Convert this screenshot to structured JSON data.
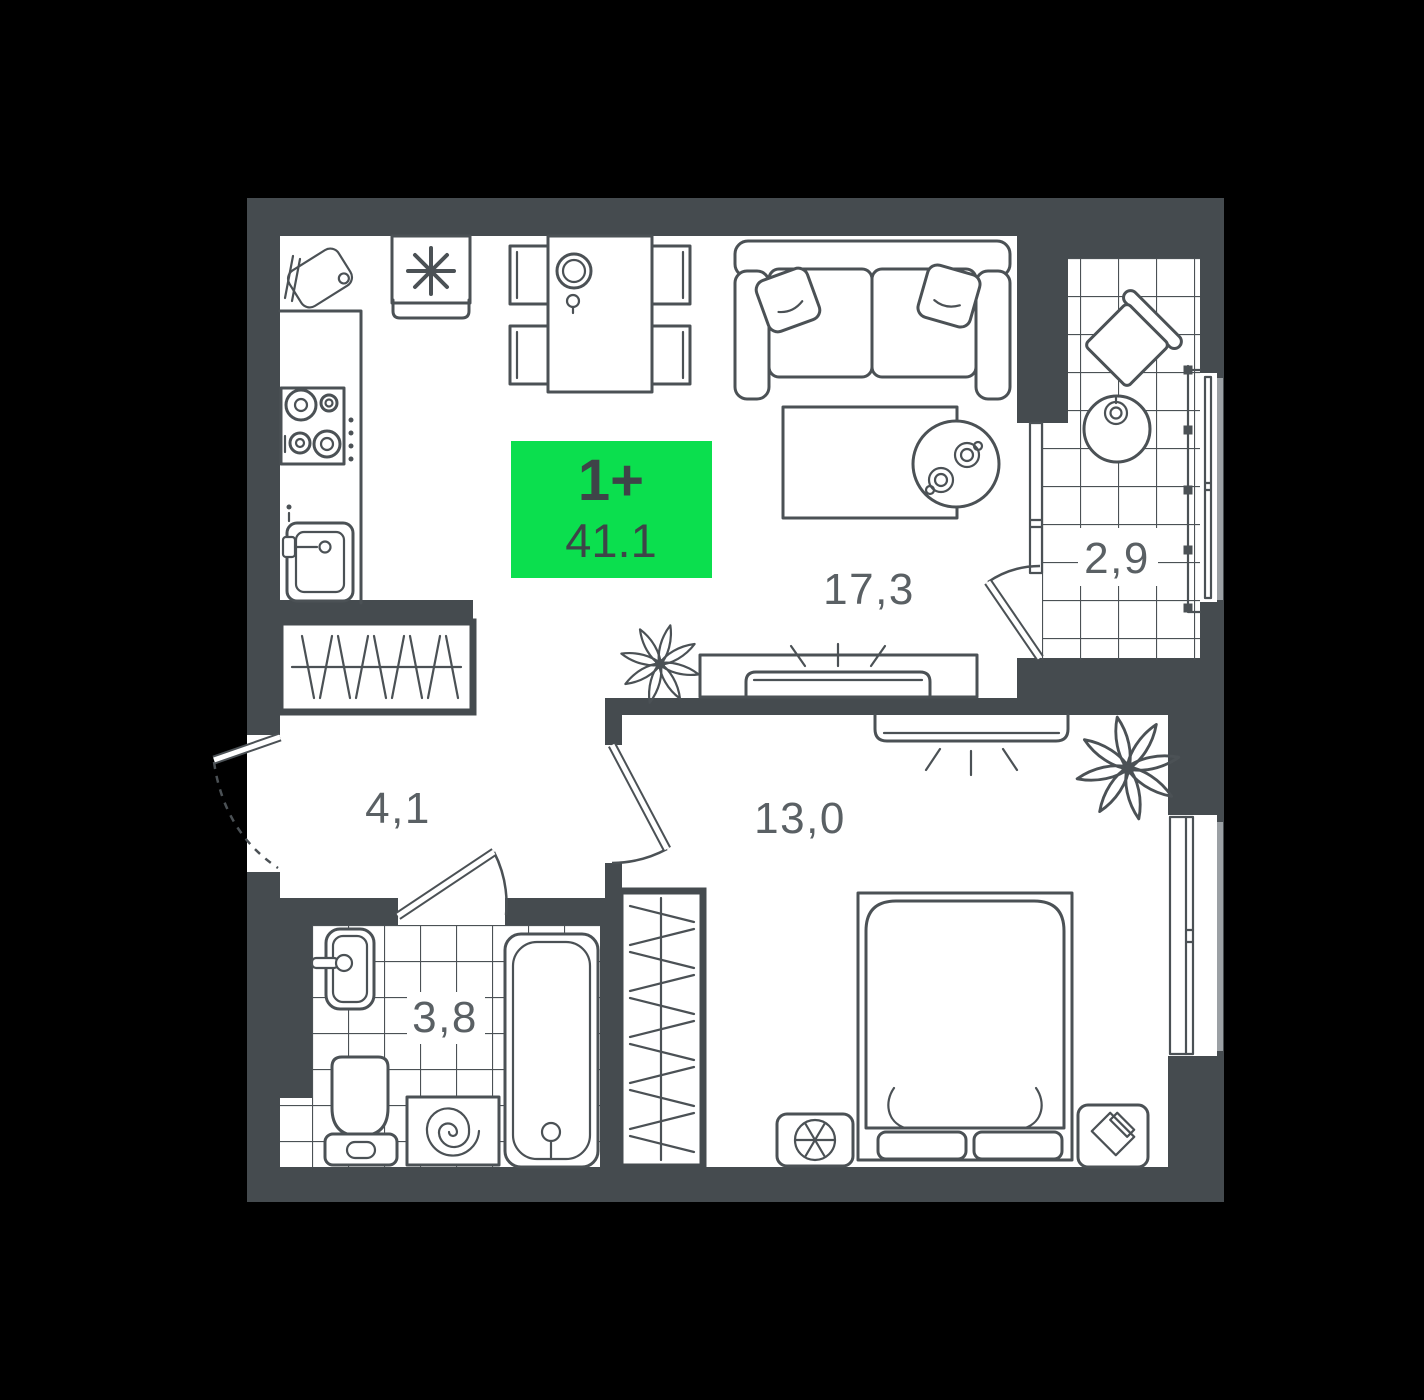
{
  "floor_plan": {
    "badge": {
      "rooms": "1+",
      "area": "41.1"
    },
    "rooms": {
      "living_kitchen": {
        "area": "17,3"
      },
      "balcony": {
        "area": "2,9"
      },
      "hallway": {
        "area": "4,1"
      },
      "bathroom": {
        "area": "3,8"
      },
      "bedroom": {
        "area": "13,0"
      }
    },
    "furniture_icons": [
      "cutting-board",
      "fridge-snowflake",
      "dining-table",
      "chairs",
      "hob",
      "kitchen-sink",
      "sofa",
      "pillows",
      "coffee-table",
      "side-table-cups",
      "tv-living",
      "plant-living",
      "balcony-chair",
      "balcony-table",
      "balcony-railing",
      "hall-wardrobe",
      "entrance-door",
      "bath-sink",
      "toilet",
      "washing-machine",
      "bathtub",
      "bedroom-wardrobe",
      "bed",
      "air-conditioner",
      "nightstand",
      "tv-bedroom",
      "plant-bedroom"
    ],
    "colors": {
      "background": "#000000",
      "wall": "#454b4f",
      "floor": "#ffffff",
      "line": "#4b5155",
      "label": "#5a6064",
      "tile": "#4b5155",
      "badge_bg": "#0bdf4e",
      "badge_text": "#3e4448",
      "sill": "#9ba0a4"
    }
  }
}
